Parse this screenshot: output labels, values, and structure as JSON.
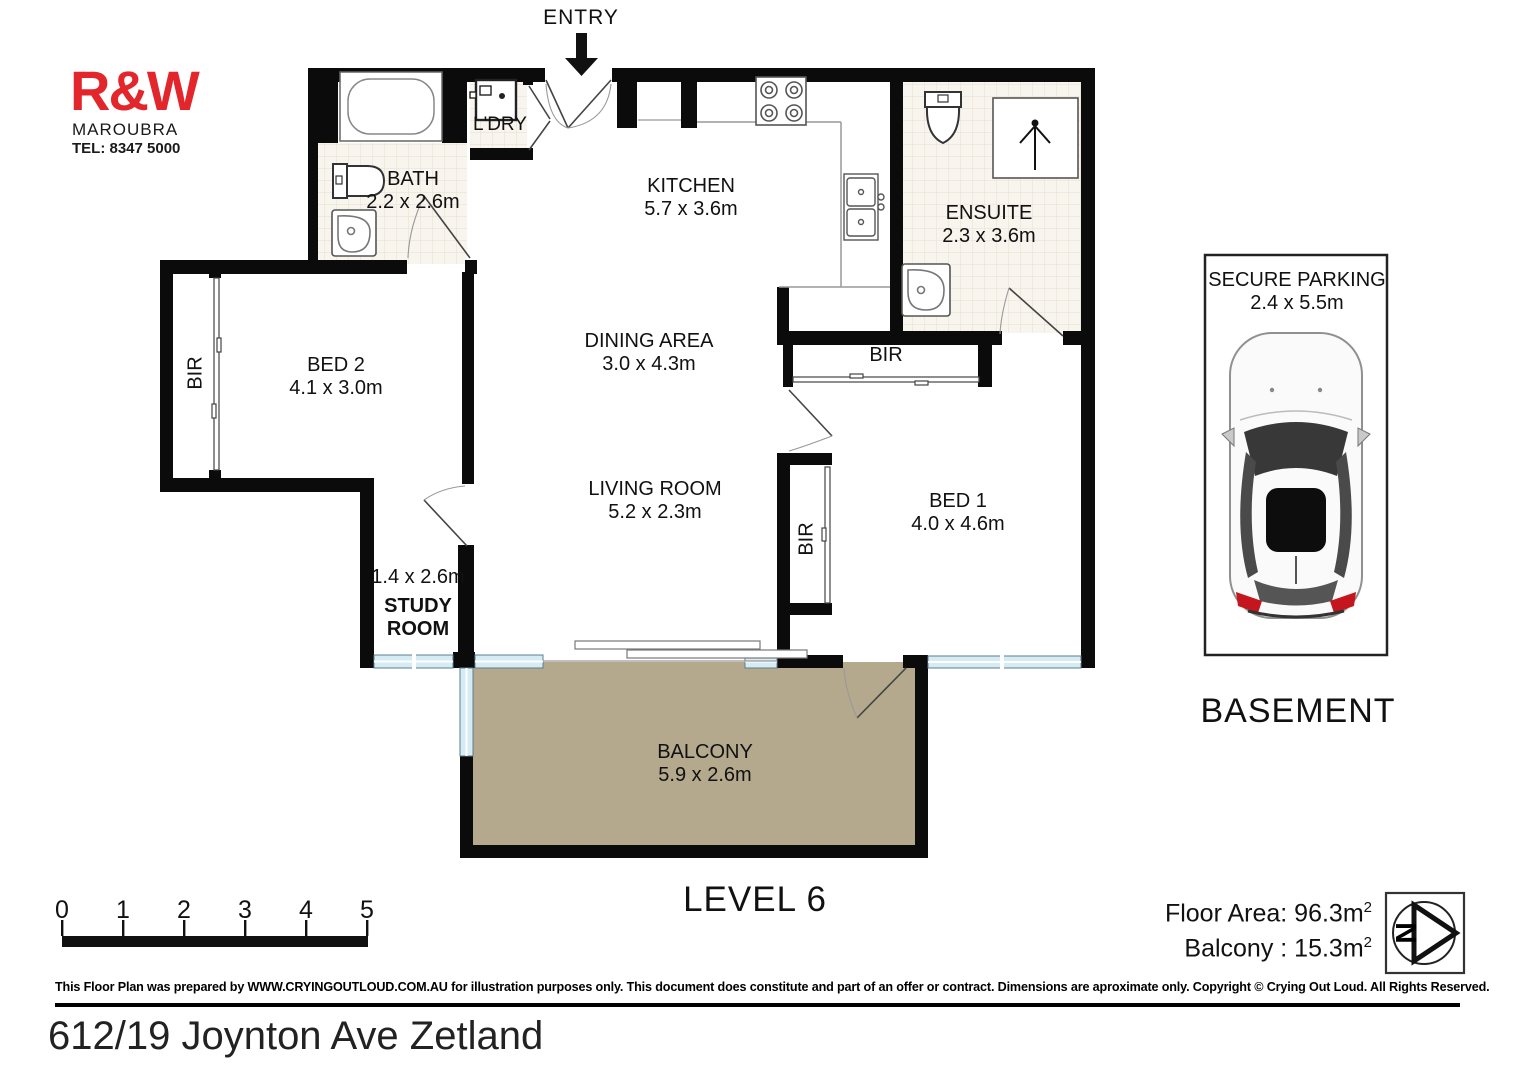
{
  "branding": {
    "logo": "R&W",
    "office": "MAROUBRA",
    "phone": "TEL: 8347 5000"
  },
  "entry_label": "ENTRY",
  "rooms": {
    "bath": {
      "name": "BATH",
      "dims": "2.2 x 2.6m"
    },
    "laundry": {
      "name": "L'DRY"
    },
    "kitchen": {
      "name": "KITCHEN",
      "dims": "5.7 x 3.6m"
    },
    "ensuite": {
      "name": "ENSUITE",
      "dims": "2.3 x 3.6m"
    },
    "bed2": {
      "name": "BED 2",
      "dims": "4.1 x 3.0m"
    },
    "dining": {
      "name": "DINING AREA",
      "dims": "3.0 x 4.3m"
    },
    "living": {
      "name": "LIVING ROOM",
      "dims": "5.2 x 2.3m"
    },
    "bed1": {
      "name": "BED 1",
      "dims": "4.0 x 4.6m"
    },
    "study": {
      "dims": "1.4 x 2.6m",
      "name1": "STUDY",
      "name2": "ROOM"
    },
    "balcony": {
      "name": "BALCONY",
      "dims": "5.9 x 2.6m"
    },
    "bir": "BIR"
  },
  "parking": {
    "title": "SECURE PARKING",
    "dims": "2.4 x 5.5m",
    "caption": "BASEMENT"
  },
  "level_label": "LEVEL 6",
  "scale_ticks": [
    "0",
    "1",
    "2",
    "3",
    "4",
    "5"
  ],
  "areas": {
    "floor_label": "Floor Area: 96.3m",
    "balcony_label": "Balcony : 15.3m",
    "sup": "2"
  },
  "compass_letter": "N",
  "footer": {
    "disclaimer": "This Floor Plan was prepared by WWW.CRYINGOUTLOUD.COM.AU for illustration purposes only. This document does constitute and part of an offer or contract. Dimensions are aproximate only. Copyright © Crying Out Loud. All Rights Reserved.",
    "address": "612/19 Joynton Ave Zetland"
  },
  "colors": {
    "wall": "#0b0b0b",
    "logo_red": "#e3262b",
    "balcony_fill": "#b4a98d",
    "window_fill": "#d6ecf5",
    "tile_line": "#e9decd"
  }
}
